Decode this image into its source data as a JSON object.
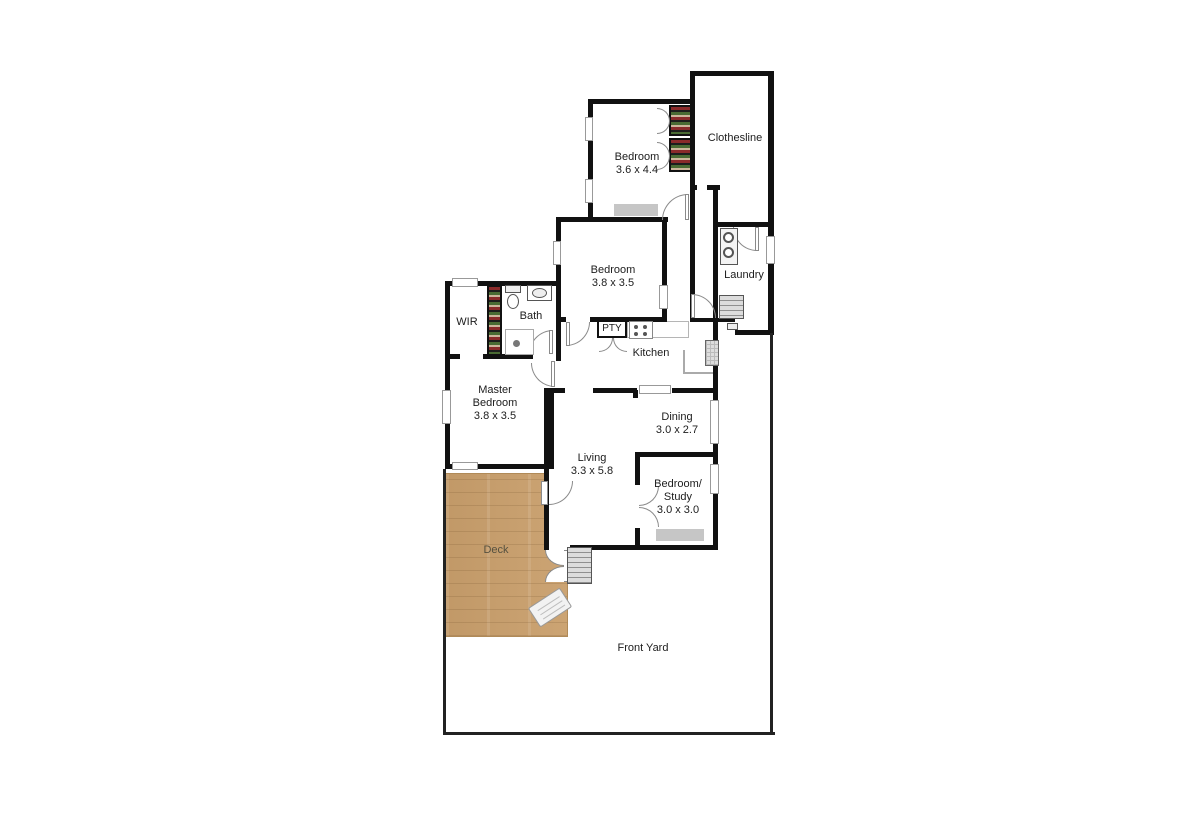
{
  "plan": {
    "rooms": {
      "bedroom_top": {
        "name": "Bedroom",
        "dims": "3.6 x 4.4"
      },
      "clothesline": {
        "name": "Clothesline"
      },
      "bedroom_mid": {
        "name": "Bedroom",
        "dims": "3.8 x 3.5"
      },
      "laundry": {
        "name": "Laundry"
      },
      "wir": {
        "name": "WIR"
      },
      "bath": {
        "name": "Bath"
      },
      "pantry": {
        "name": "PTY"
      },
      "kitchen": {
        "name": "Kitchen"
      },
      "master_bedroom": {
        "name_line1": "Master",
        "name_line2": "Bedroom",
        "dims": "3.8 x 3.5"
      },
      "dining": {
        "name": "Dining",
        "dims": "3.0 x 2.7"
      },
      "living": {
        "name": "Living",
        "dims": "3.3 x 5.8"
      },
      "study": {
        "name_line1": "Bedroom/",
        "name_line2": "Study",
        "dims": "3.0 x 3.0"
      },
      "deck": {
        "name": "Deck"
      },
      "front_yard": {
        "name": "Front Yard"
      }
    },
    "colors": {
      "wall": "#111111",
      "fence": "#222222",
      "deck_wood": "#c99f6c",
      "window_seat": "#c6c6c6",
      "stairs": "#dcdcdc",
      "label_text": "#1c1c1c"
    }
  }
}
